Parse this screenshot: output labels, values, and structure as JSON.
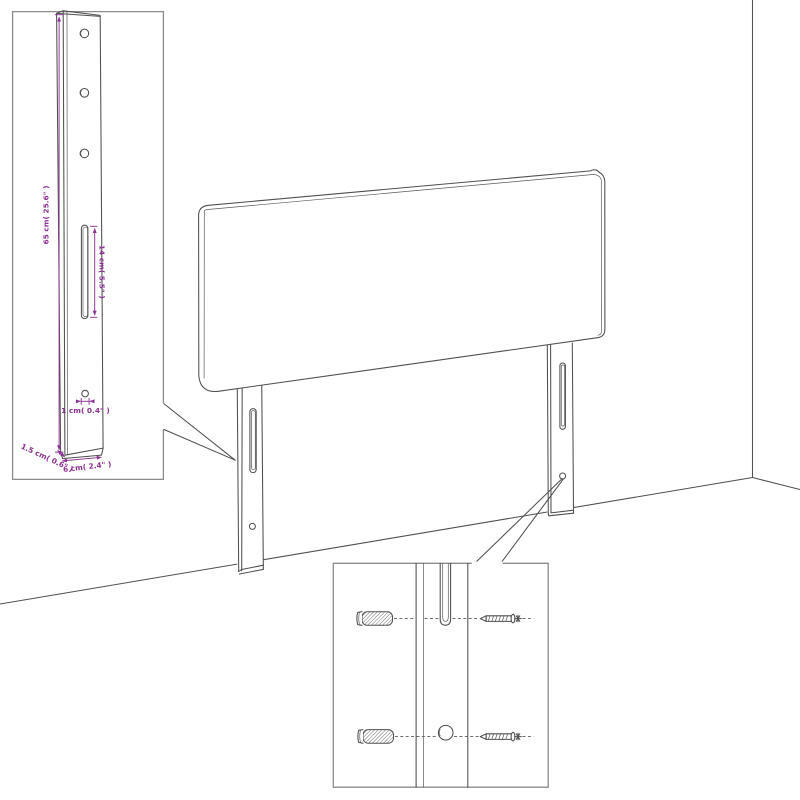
{
  "figure": {
    "kind": "product-dimension-line-drawing",
    "subject": "headboard-with-mounting-legs-against-wall"
  },
  "colors": {
    "background": "#ffffff",
    "drawing_line": "#4f4f4f",
    "inset_border": "#8c8c8c",
    "dimension_accent": "#8b3392"
  },
  "leg_detail_inset": {
    "labels": {
      "height": "65 cm( 25.6\" )",
      "slot_length": "14 cm( 5.5\" )",
      "hole_diameter": "1 cm( 0.4\" )",
      "width": "6 cm( 2.4\" )",
      "depth": "1.5 cm( 0.6\" )"
    }
  }
}
